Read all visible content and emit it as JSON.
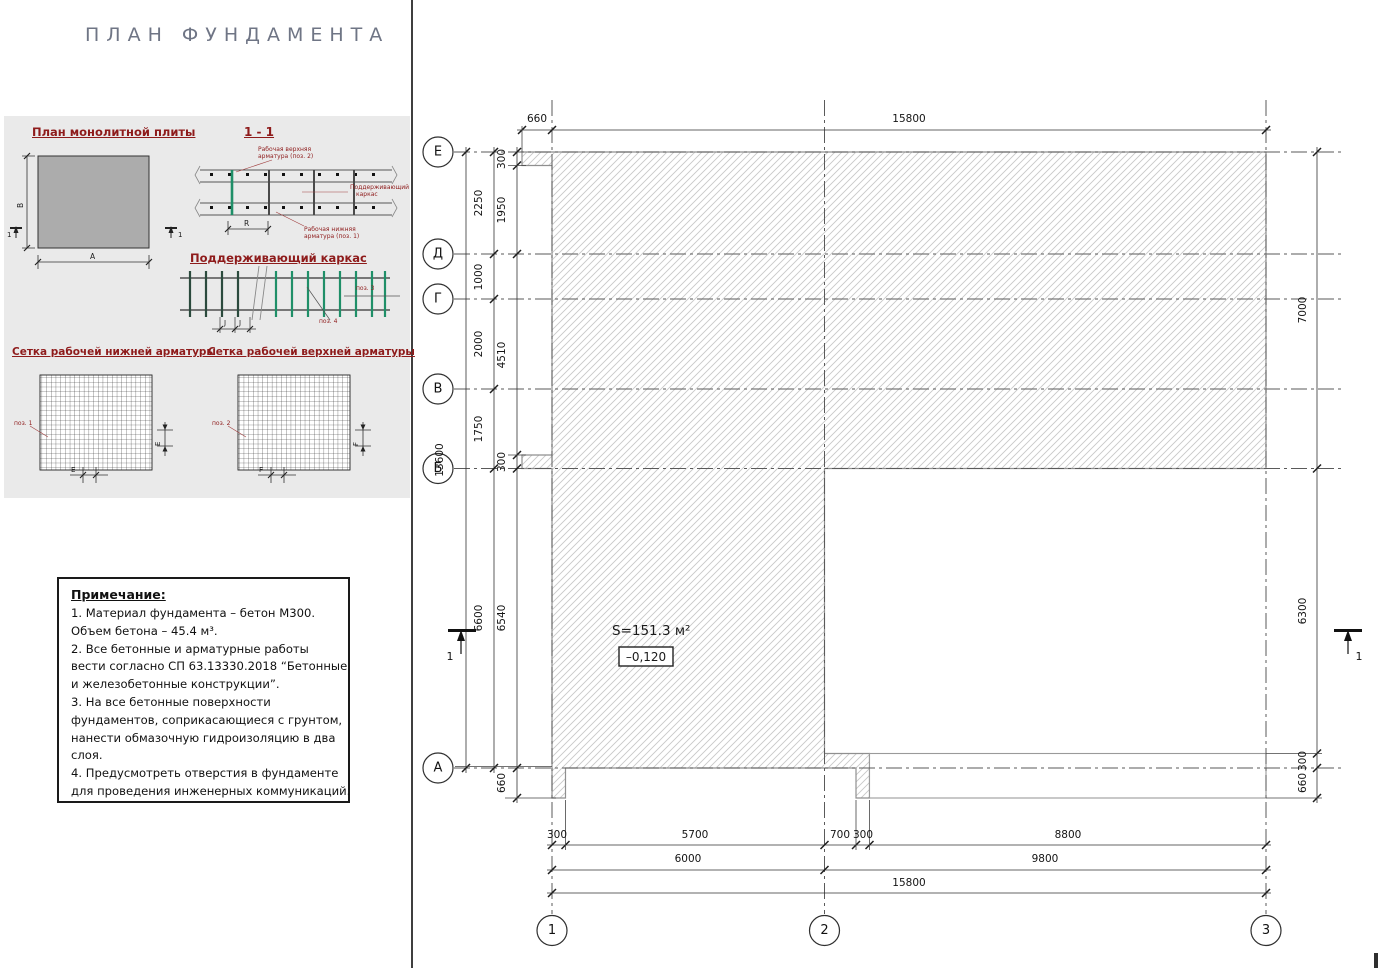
{
  "title": "ПЛАН ФУНДАМЕНТА",
  "palette": {
    "heading_red": "#8e1b1b",
    "title_gray": "#6f7585",
    "frame_green": "#1f8f68",
    "slab_gray": "#acacac",
    "hatch_gray": "#c8c8c8"
  },
  "panel": {
    "slab_plan": {
      "heading": "План монолитной плиты",
      "width_label": "A",
      "height_label": "B",
      "section_mark": "1"
    },
    "section": {
      "heading": "1 - 1",
      "top1": "Рабочая верхняя",
      "top2": "арматура (поз. 2)",
      "right1": "Поддерживающий",
      "right2": "каркас",
      "bot1": "Рабочая нижняя",
      "bot2": "арматура (поз. 1)",
      "dim": "R"
    },
    "frame": {
      "heading": "Поддерживающий каркас",
      "pos3": "поз. 3",
      "pos4": "поз. 4",
      "dim": "J"
    },
    "mesh_bottom": {
      "heading": "Сетка рабочей нижней арматуры",
      "pos": "поз. 1",
      "dim": "E"
    },
    "mesh_top": {
      "heading": "Сетка рабочей верхней арматуры",
      "pos": "поз. 2",
      "dim": "F"
    }
  },
  "notes": {
    "heading": "Примечание:",
    "lines": [
      "1. Материал фундамента – бетон М300.",
      "Объем бетона –  45.4 м³.",
      "2. Все бетонные и арматурные работы",
      "вести согласно СП 63.13330.2018 “Бетонные",
      "и железобетонные конструкции”.",
      "3. На все бетонные поверхности",
      "фундаментов, соприкасающиеся с грунтом,",
      "нанести обмазочную гидроизоляцию в два",
      "слоя.",
      "4. Предусмотреть отверстия в фундаменте",
      "для проведения инженерных коммуникаций."
    ]
  },
  "plan": {
    "area_label": "S=151.3 м²",
    "elevation": "–0,120",
    "section_mark": "1",
    "axes_rows": [
      {
        "label": "Е",
        "y": 152
      },
      {
        "label": "Д",
        "y": 254
      },
      {
        "label": "Г",
        "y": 299
      },
      {
        "label": "В",
        "y": 389
      },
      {
        "label": "Б",
        "y": 468.5
      },
      {
        "label": "А",
        "y": 768
      }
    ],
    "axes_cols": [
      {
        "label": "1",
        "x": 552
      },
      {
        "label": "2",
        "x": 824.5
      },
      {
        "label": "3",
        "x": 1266
      }
    ],
    "dim_labels": [
      {
        "t": "660",
        "x": 537,
        "y": 122
      },
      {
        "t": "15800",
        "x": 909,
        "y": 122
      },
      {
        "t": "300",
        "x": 557,
        "y": 838
      },
      {
        "t": "5700",
        "x": 695,
        "y": 838
      },
      {
        "t": "700",
        "x": 840,
        "y": 838
      },
      {
        "t": "300",
        "x": 863,
        "y": 838
      },
      {
        "t": "8800",
        "x": 1068,
        "y": 838
      },
      {
        "t": "6000",
        "x": 688,
        "y": 862
      },
      {
        "t": "9800",
        "x": 1045,
        "y": 862
      },
      {
        "t": "15800",
        "x": 909,
        "y": 886
      },
      {
        "t": "13600",
        "x": 443,
        "y": 460,
        "r": 1
      },
      {
        "t": "2250",
        "x": 482,
        "y": 203,
        "r": 1
      },
      {
        "t": "1000",
        "x": 482,
        "y": 277,
        "r": 1
      },
      {
        "t": "2000",
        "x": 482,
        "y": 344,
        "r": 1
      },
      {
        "t": "1750",
        "x": 482,
        "y": 429,
        "r": 1
      },
      {
        "t": "6600",
        "x": 482,
        "y": 618,
        "r": 1
      },
      {
        "t": "300",
        "x": 505,
        "y": 159,
        "r": 1
      },
      {
        "t": "1950",
        "x": 505,
        "y": 210,
        "r": 1
      },
      {
        "t": "4510",
        "x": 505,
        "y": 355,
        "r": 1
      },
      {
        "t": "300",
        "x": 505,
        "y": 462,
        "r": 1
      },
      {
        "t": "6540",
        "x": 505,
        "y": 618,
        "r": 1
      },
      {
        "t": "660",
        "x": 505,
        "y": 783,
        "r": 1
      },
      {
        "t": "7000",
        "x": 1306,
        "y": 310,
        "r": 1
      },
      {
        "t": "6300",
        "x": 1306,
        "y": 611,
        "r": 1
      },
      {
        "t": "300",
        "x": 1306,
        "y": 761,
        "r": 1
      },
      {
        "t": "660",
        "x": 1306,
        "y": 783,
        "r": 1
      }
    ]
  }
}
